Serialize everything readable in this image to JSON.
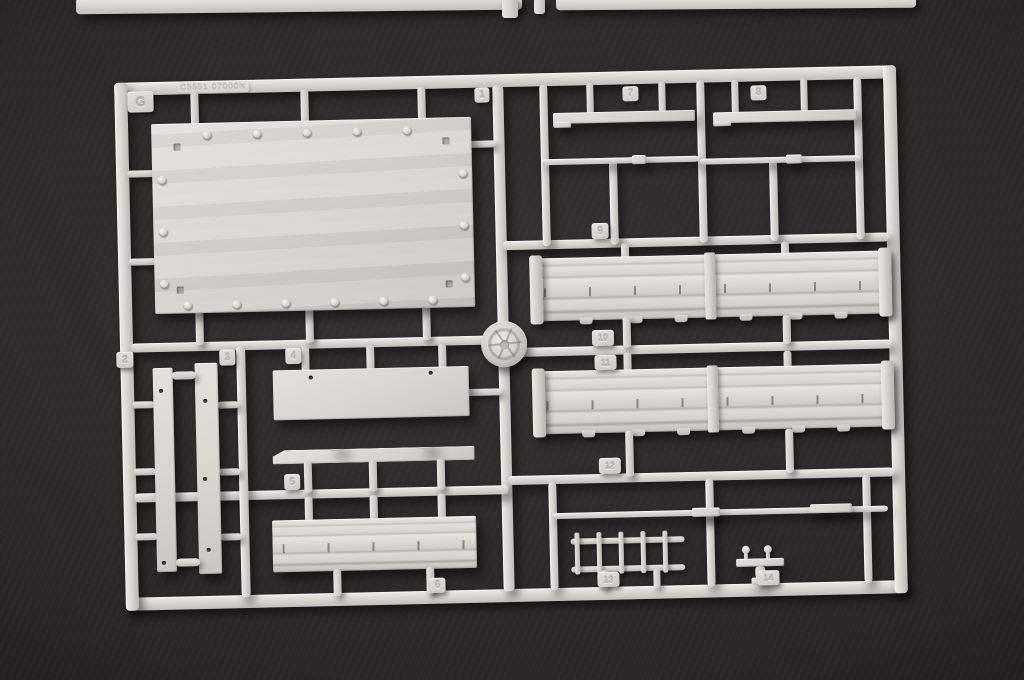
{
  "scene": {
    "description": "Photograph of a light-grey injection-molded plastic model kit sprue (runner frame G) holding parts numbered 1 to 14, lying on a dark charcoal surface",
    "background_color": "#2b2a28",
    "plastic_color": "#d7d5d0"
  },
  "sprue": {
    "mold_code": "C5551 07000N",
    "tags": {
      "letter": "G",
      "n1": "1",
      "n2": "2",
      "n3": "3",
      "n4": "4",
      "n5": "5",
      "n6": "6",
      "n7": "7",
      "n8": "8",
      "n9": "9",
      "n10": "10",
      "n11": "11",
      "n12": "12",
      "n13": "13",
      "n14": "14"
    }
  }
}
